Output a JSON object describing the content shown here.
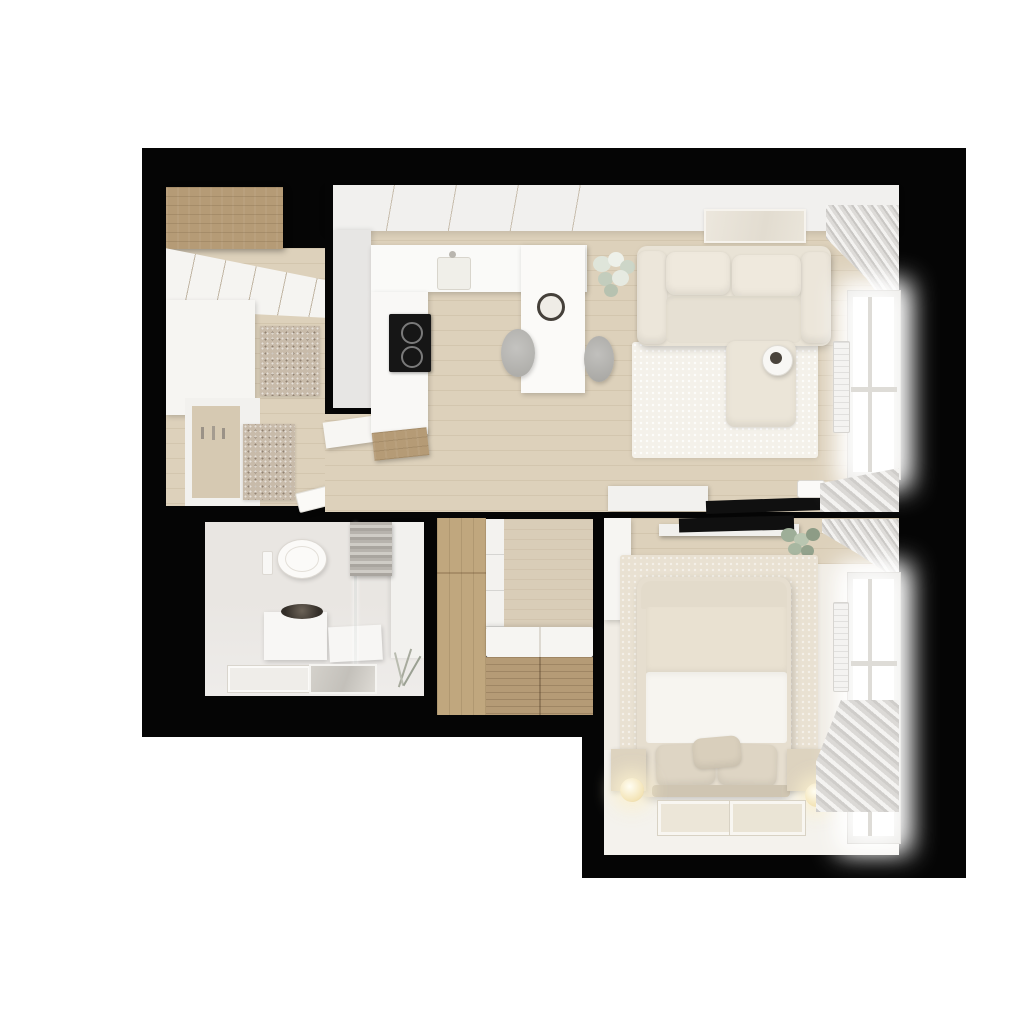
{
  "meta": {
    "title": "Small apartment floor plan - photorealistic top-down 3D render",
    "view": "axonometric top view",
    "page_background": "#ffffff",
    "plan_backdrop": "#050505"
  },
  "palette": {
    "wood_cabinet": "#b59b76",
    "wood_wardrobe": "#c0a77e",
    "floor_wood": "#ddd1bb",
    "white_surface": "#f6f5f2",
    "sofa_cream": "#e9e3d6",
    "rug_living": "#f4f1ea",
    "rug_bedroom": "#e9e1d2",
    "rug_speckle": "#c8bbaa",
    "bath_wall": "#e9e6e2",
    "bath_floor": "#eeecea",
    "curtain": "#d8d6d3",
    "cooktop_black": "#161616",
    "tv_black": "#101010",
    "basin_dark": "#332e28",
    "lamp_warm": "#f3e3b5",
    "plant_green": "#9eae98"
  },
  "rooms": {
    "entry_hall": {
      "label": "Entry hall",
      "furniture": [
        "wood top cabinet",
        "white sliding wardrobe",
        "coat hook niche",
        "speckled doormat",
        "speckled runner rug",
        "open white door"
      ]
    },
    "kitchen": {
      "label": "Kitchen",
      "furniture": [
        "white u-shaped counter",
        "sink",
        "black induction cooktop",
        "tall gray cabinet wall",
        "peninsula table",
        "two gray round stools",
        "dark-rim decor bowl",
        "wood end panel"
      ]
    },
    "living_room": {
      "label": "Living room",
      "furniture": [
        "cream corner sofa with chaise",
        "round white side table with dark tray",
        "white shag rug",
        "beige wall art",
        "white flower plant",
        "window with curtains",
        "radiator",
        "white tv sideboard",
        "flat black tv",
        "wall outlet"
      ]
    },
    "bathroom": {
      "label": "Bathroom",
      "furniture": [
        "wall-hung toilet",
        "flush plate",
        "vanity with dark round basin",
        "white storage cabinet",
        "glass shower screen",
        "bath mat",
        "glossy shower mat",
        "hanging towels",
        "dry plant sprig"
      ]
    },
    "walk_in_closet": {
      "label": "Walk-in closet",
      "furniture": [
        "l-shaped wood wardrobe",
        "white shelf stack",
        "white bench cushions",
        "wood slatted drawer unit"
      ]
    },
    "bedroom": {
      "label": "Bedroom",
      "furniture": [
        "double bed with beige blanket and white duvet",
        "three pillows",
        "two beige nightstand cubes",
        "two glowing sphere lamps",
        "beige area rug",
        "two framed artworks on floor",
        "white wardrobe",
        "wall tv on white shelf",
        "eucalyptus plant",
        "window with curtains",
        "radiator"
      ]
    }
  }
}
